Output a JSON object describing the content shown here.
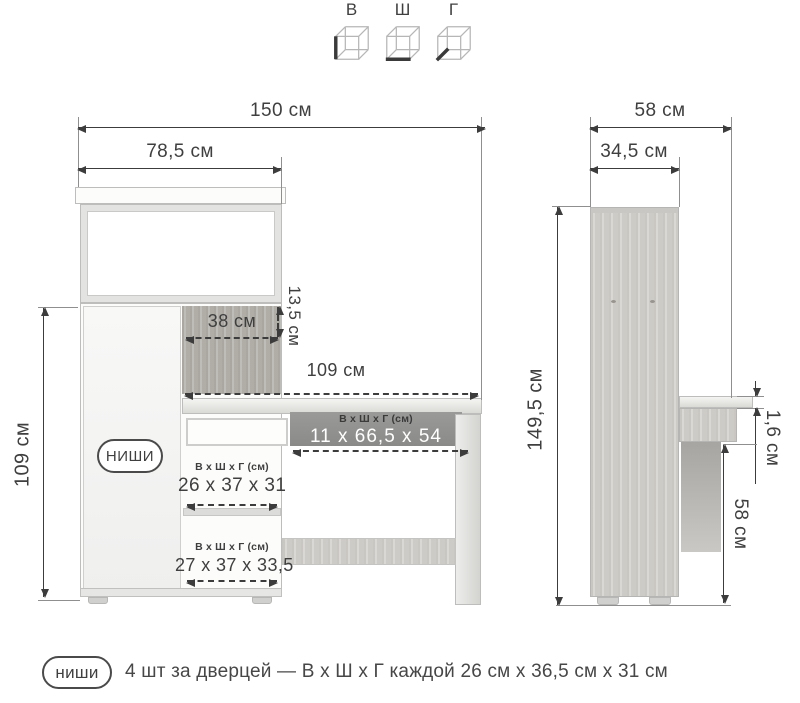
{
  "legend": {
    "items": [
      {
        "label": "В",
        "icon": "height-cube-icon"
      },
      {
        "label": "Ш",
        "icon": "width-cube-icon"
      },
      {
        "label": "Г",
        "icon": "depth-cube-icon"
      }
    ]
  },
  "front_view": {
    "dims": {
      "total_width": "150 см",
      "hutch_width": "78,5 см",
      "cabinet_height": "109 см",
      "open_niche_width": "38 см",
      "open_niche_height": "13,5 см",
      "desk_width": "109 см"
    },
    "niches_label": "НИШИ",
    "under_desk": {
      "header": "В х Ш х Г (см)",
      "value": "11 х 66,5 х 54"
    },
    "niche1": {
      "header": "В х Ш х Г (см)",
      "value": "26 х 37 х 31"
    },
    "niche2": {
      "header": "В х Ш х Г (см)",
      "value": "27 х 37 х 33,5"
    }
  },
  "side_view": {
    "dims": {
      "total_depth": "58 см",
      "cabinet_depth": "34,5 см",
      "total_height": "149,5 см",
      "desktop_thickness": "1,6 см",
      "desk_clearance": "58 см"
    }
  },
  "footnote": {
    "badge": "ниши",
    "text": "4 шт за дверцей — В х Ш х Г каждой 26 см х 36,5 см х 31 см"
  }
}
